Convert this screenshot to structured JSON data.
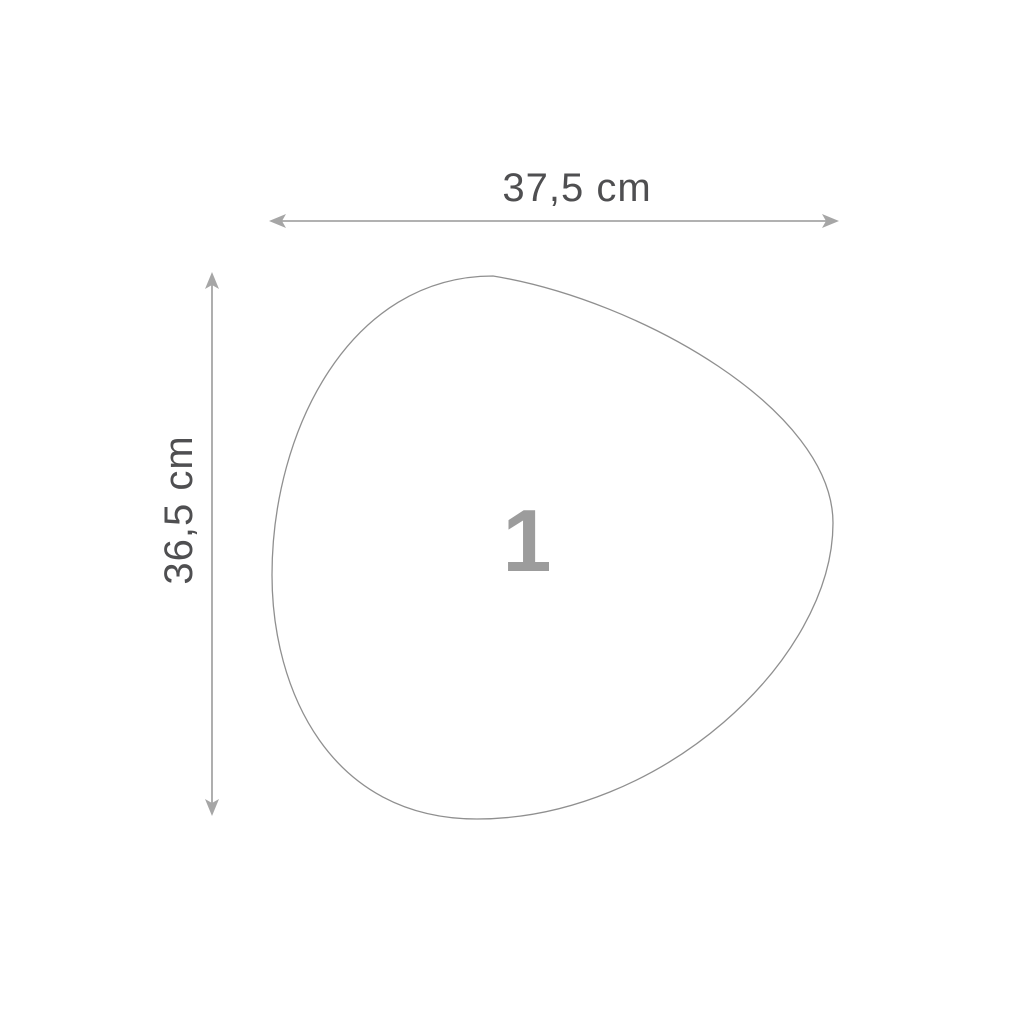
{
  "diagram": {
    "part_number": "1",
    "dimensions": {
      "width": {
        "label": "37,5 cm",
        "value_cm": 37.5
      },
      "height": {
        "label": "36,5 cm",
        "value_cm": 36.5
      }
    },
    "shape": "organic-pebble-outline",
    "colors": {
      "background": "#ffffff",
      "label_text": "#4f4f51",
      "dimension_line": "#a6a6a6",
      "shape_outline": "#8f8f8f",
      "part_number_text": "#9c9c9c"
    }
  }
}
